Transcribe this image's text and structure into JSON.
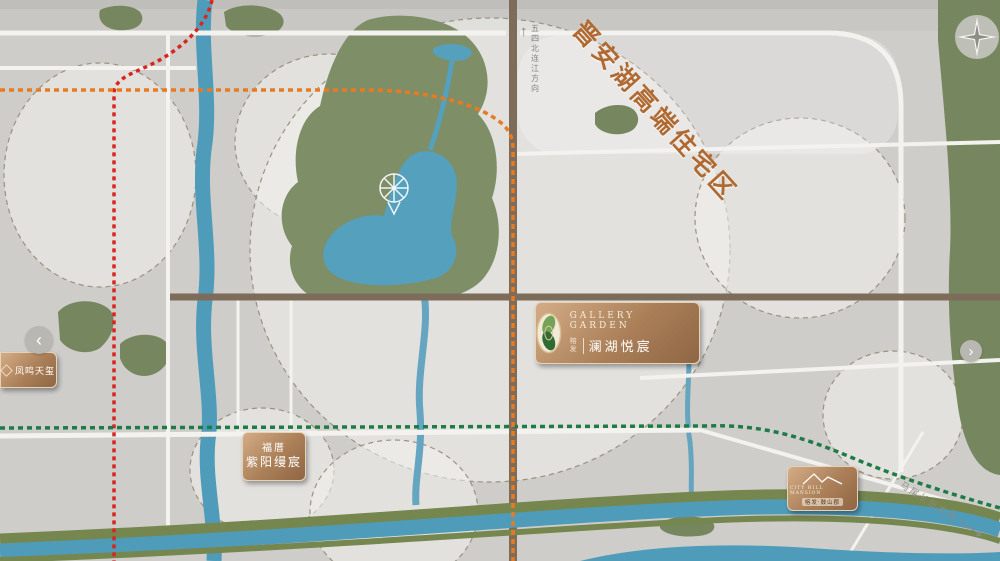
{
  "banner": "晋安湖高端住宅区",
  "project": {
    "en": "GALLERY GARDEN",
    "brand": "榕发",
    "name": "澜湖悦宸"
  },
  "boxes": {
    "phoenix": {
      "name": "凤鸣天玺"
    },
    "fucuo": {
      "line1": "福厝",
      "line2": "紫阳缦宸"
    },
    "cityhill": {
      "en": "CITY HILL MANSION",
      "zh": "榕发·鼓山郡"
    }
  },
  "carousel": {
    "left": "‹",
    "right": "›"
  },
  "compass": {
    "n": "N",
    "w": "W",
    "s": "S",
    "e": "E"
  },
  "directions": {
    "north": "五四北连江方向",
    "southeast": "马尾长乐方向"
  },
  "metro": {
    "lines": [
      {
        "id": "l1",
        "name": "地铁1号线",
        "color": "#d9251d"
      },
      {
        "id": "l2",
        "name": "地铁2号线",
        "color": "#1e7b45"
      },
      {
        "id": "l4",
        "name": "地铁4号线",
        "color": "#e87a22"
      }
    ],
    "stations": [
      {
        "name": "东街口站",
        "ix": 115,
        "iy": 91,
        "c": [
          "l1",
          "l4"
        ],
        "lx": 58,
        "ly": 86,
        "lw": 45,
        "lh": 14
      },
      {
        "name": "省立医院站",
        "ix": 144,
        "iy": 91,
        "c": [
          "l4"
        ],
        "lx": 117,
        "ly": 102,
        "lw": 56,
        "lh": 15
      },
      {
        "name": "东门站",
        "ix": 192,
        "iy": 91,
        "c": [
          "l4"
        ],
        "lx": 173,
        "ly": 102,
        "lw": 37,
        "lh": 15
      },
      {
        "name": "竹屿站",
        "ix": 390,
        "iy": 91,
        "c": [
          "l4"
        ],
        "lx": 370,
        "ly": 102,
        "lw": 39,
        "lh": 15
      },
      {
        "name": "横屿站",
        "ix": 512,
        "iy": 144,
        "c": [
          "l4"
        ],
        "lx": 521,
        "ly": 137,
        "lw": 39,
        "lh": 15
      },
      {
        "name": "后屿站",
        "big": 1,
        "ix": 517,
        "iy": 320,
        "c": [
          "l4"
        ],
        "lx": 447,
        "ly": 306,
        "lw": 59,
        "lh": 28
      },
      {
        "name": "前屿站",
        "ix": 513,
        "iy": 427,
        "c": [
          "l2",
          "l4"
        ],
        "lx": 464,
        "ly": 419,
        "lw": 38,
        "lh": 15
      },
      {
        "name": "光明港站",
        "ix": 512,
        "iy": 494,
        "c": [
          "l4"
        ],
        "lx": 454,
        "ly": 486,
        "lw": 48,
        "lh": 15
      },
      {
        "name": "鳌峰站",
        "ix": 512,
        "iy": 521,
        "c": [
          "l4"
        ],
        "lx": 467,
        "ly": 513,
        "lw": 37,
        "lh": 16
      },
      {
        "name": "五里亭站",
        "ix": 387,
        "iy": 426,
        "c": [
          "l2"
        ],
        "lx": 334,
        "ly": 418,
        "lw": 46,
        "lh": 15
      },
      {
        "name": "南门兜站",
        "ix": 114,
        "iy": 427,
        "c": [
          "l1",
          "l2"
        ],
        "lx": 56,
        "ly": 420,
        "lw": 47,
        "lh": 15
      }
    ]
  },
  "pills": [
    {
      "t": "前横路",
      "x": 504,
      "y": 29,
      "w": 19,
      "h": 69,
      "v": 1
    },
    {
      "t": "化工路",
      "x": 585,
      "y": 147,
      "w": 72,
      "h": 19
    },
    {
      "t": "福新东路",
      "x": 711,
      "y": 284,
      "w": 98,
      "h": 23
    },
    {
      "t": "后屿路",
      "x": 694,
      "y": 363,
      "w": 72,
      "h": 18
    },
    {
      "t": "古田路",
      "x": 134,
      "y": 422,
      "w": 71,
      "h": 25
    },
    {
      "t": "光明港路",
      "x": 374,
      "y": 504,
      "w": 78,
      "h": 18
    },
    {
      "t": "五一中路",
      "x": 159,
      "y": 276,
      "w": 18,
      "h": 58,
      "v": 1
    },
    {
      "t": "长乐路",
      "x": 229,
      "y": 331,
      "w": 17,
      "h": 81,
      "v": 1
    },
    {
      "t": "连江路",
      "x": 283,
      "y": 336,
      "w": 17,
      "h": 75,
      "v": 1
    },
    {
      "t": "东三环",
      "x": 899,
      "y": 268,
      "w": 19,
      "h": 56,
      "v": 1
    },
    {
      "t": "地铁4号线",
      "x": 243,
      "y": 84,
      "w": 90,
      "h": 17,
      "k": "l4"
    },
    {
      "t": "地铁2号线",
      "x": 712,
      "y": 416,
      "w": 76,
      "h": 16,
      "k": "l2"
    },
    {
      "t": "地铁1号线",
      "x": 105,
      "y": 456,
      "w": 17,
      "h": 66,
      "v": 1,
      "k": "l1"
    }
  ],
  "zone_labels": [
    {
      "text": "东街口商圈",
      "x": 84,
      "y": 148,
      "c": "green",
      "size": 11
    },
    {
      "text": "东泰禾商圈",
      "x": 340,
      "y": 164,
      "c": "green",
      "size": 11
    },
    {
      "lines": [
        "三创园",
        "经济核心区"
      ],
      "x": 752,
      "y": 197,
      "c": "orange",
      "size": 12
    },
    {
      "text": "宜家商圈",
      "x": 884,
      "y": 391,
      "c": "orange",
      "size": 11
    },
    {
      "text": "王庄商圈",
      "x": 266,
      "y": 484,
      "c": "gold",
      "size": 11
    },
    {
      "text": "金融街商圈",
      "x": 363,
      "y": 545,
      "c": "gold",
      "size": 11
    },
    {
      "text": "晋安湖公园",
      "x": 342,
      "y": 243,
      "c": "white",
      "size": 16,
      "ls": 6
    },
    {
      "text": "鼓山风景区",
      "x": 980,
      "y": 188,
      "c": "dgreen",
      "size": 10,
      "ls": 5,
      "v": 1
    }
  ],
  "river_labels": [
    {
      "text": "晋安河",
      "x": 202,
      "y": 342,
      "v": 1,
      "size": 8
    },
    {
      "text": "浦东河",
      "x": 684,
      "y": 370,
      "v": 1,
      "size": 6
    },
    {
      "text": "光明港",
      "x": 693,
      "y": 500,
      "size": 9,
      "ls": 4
    },
    {
      "text": "闽 江",
      "x": 648,
      "y": 548,
      "size": 10,
      "ls": 3
    }
  ],
  "pois": [
    {
      "t": [
        "东百中心"
      ],
      "x": 96,
      "y": 66,
      "i": "b"
    },
    {
      "t": [
        "三坊七巷",
        "历史文化街区"
      ],
      "x": 84,
      "y": 107,
      "i": "b"
    },
    {
      "t": [
        "大洋百货"
      ],
      "x": 135,
      "y": 123,
      "i": "b"
    },
    {
      "t": [
        "省立医院"
      ],
      "x": 141,
      "y": 72
    },
    {
      "t": [
        "福建省第二",
        "人民医院(东二环院区)"
      ],
      "x": 253,
      "y": 54,
      "i": "b"
    },
    {
      "t": [
        "福州第",
        "四十三",
        "中学"
      ],
      "x": 222,
      "y": 138,
      "i": "b"
    },
    {
      "t": [
        "泰禾广场"
      ],
      "x": 316,
      "y": 105,
      "i": "b"
    },
    {
      "t": [
        "福州新南方",
        "家居建材旗舰中心"
      ],
      "x": 322,
      "y": 181
    },
    {
      "t": [
        "福州市晋安",
        "榕博小学"
      ],
      "x": 357,
      "y": 57,
      "i": "b"
    },
    {
      "t": [
        "福州科技馆"
      ],
      "x": 486,
      "y": 69,
      "i": "b"
    },
    {
      "t": [
        "福州市",
        "晋安榕博小学",
        "(东区)"
      ],
      "x": 482,
      "y": 115
    },
    {
      "t": [
        "第十一中学"
      ],
      "x": 554,
      "y": 95,
      "i": "b"
    },
    {
      "t": [
        "福州市晋安区",
        "第二实验幼儿园"
      ],
      "x": 576,
      "y": 58,
      "i": "b"
    },
    {
      "t": [
        "横屿幼儿园"
      ],
      "x": 572,
      "y": 130,
      "i": "b",
      "p": "l"
    },
    {
      "t": [
        "福州市潭园小学"
      ],
      "x": 721,
      "y": 58
    },
    {
      "t": [
        "福州第十一中学",
        "(横屿校区)"
      ],
      "x": 724,
      "y": 99,
      "i": "b"
    },
    {
      "t": [
        "福建省儿童医院"
      ],
      "x": 779,
      "y": 102
    },
    {
      "t": [
        "福州市鼓山中心幼儿园"
      ],
      "x": 788,
      "y": 123,
      "i": "b"
    },
    {
      "t": [
        "三创中心"
      ],
      "x": 830,
      "y": 176,
      "i": "b"
    },
    {
      "t": [
        "未来科技大厦"
      ],
      "x": 810,
      "y": 235
    },
    {
      "t": [
        "IGG总部大厦"
      ],
      "x": 750,
      "y": 271
    },
    {
      "t": [
        "麦克赛尔",
        "数字映像(中国)"
      ],
      "x": 826,
      "y": 258,
      "i": "b"
    },
    {
      "t": [
        "梁厝",
        "科创园"
      ],
      "x": 700,
      "y": 243,
      "i": "b"
    },
    {
      "t": [
        "盛辉物流",
        "集团有限公司"
      ],
      "x": 560,
      "y": 188,
      "i": "b"
    },
    {
      "t": [
        "晋安区",
        "数字虚拟产业园"
      ],
      "x": 643,
      "y": 180,
      "i": "b"
    },
    {
      "t": [
        "福兴家居",
        "物联网展示中心"
      ],
      "x": 601,
      "y": 255,
      "i": "b"
    },
    {
      "t": [
        "福兴投资区"
      ],
      "x": 830,
      "y": 325,
      "i": "b",
      "p": "l"
    },
    {
      "t": [
        "高意科技"
      ],
      "x": 661,
      "y": 341
    },
    {
      "t": [
        "福兴妇产医院"
      ],
      "x": 754,
      "y": 396,
      "i": "h",
      "p": "l"
    },
    {
      "t": [
        "宜家"
      ],
      "x": 877,
      "y": 408,
      "i": "b"
    },
    {
      "t": [
        "福州格致中学",
        "(鼓山校区)"
      ],
      "x": 816,
      "y": 438,
      "i": "b"
    },
    {
      "t": [
        "晋安区",
        "气象局"
      ],
      "x": 497,
      "y": 355,
      "i": "s"
    },
    {
      "t": [
        "福州市",
        "鼓山中心小学"
      ],
      "x": 447,
      "y": 335,
      "i": "b"
    },
    {
      "t": [
        "鼓山中医院"
      ],
      "x": 452,
      "y": 379,
      "i": "b"
    },
    {
      "t": [
        "福州二十中"
      ],
      "x": 495,
      "y": 390,
      "i": "b"
    },
    {
      "t": [
        "福马商业广场"
      ],
      "x": 455,
      "y": 400,
      "i": "b"
    },
    {
      "t": [
        "福州博爱中医院"
      ],
      "x": 363,
      "y": 385,
      "i": "b"
    },
    {
      "t": [
        "晋安区教师进修",
        "学校附属小学"
      ],
      "x": 362,
      "y": 314,
      "i": "b"
    },
    {
      "t": [
        "福兴实验幼儿园"
      ],
      "x": 354,
      "y": 350,
      "i": "b",
      "p": "l"
    },
    {
      "t": [
        "大润发"
      ],
      "x": 262,
      "y": 373,
      "i": "b"
    },
    {
      "t": [
        "世欧",
        "广场"
      ],
      "x": 230,
      "y": 450,
      "i": "b"
    },
    {
      "t": [
        "沃尔玛(晋安店)"
      ],
      "x": 572,
      "y": 457,
      "i": "b",
      "p": "l"
    },
    {
      "t": [
        "福州市鼓山新区小学"
      ],
      "x": 570,
      "y": 477,
      "i": "b"
    },
    {
      "t": [
        "源脉温泉·温泉水乐园"
      ],
      "x": 730,
      "y": 481
    },
    {
      "t": [
        "远洋小学"
      ],
      "x": 766,
      "y": 465,
      "i": "b"
    },
    {
      "t": [
        "福州华伦中学",
        "(台江校区)"
      ],
      "x": 707,
      "y": 521,
      "i": "b"
    },
    {
      "t": [
        "富闽",
        "时代广场"
      ],
      "x": 428,
      "y": 516,
      "i": "b"
    },
    {
      "t": [
        "金融街万达广场"
      ],
      "x": 422,
      "y": 540,
      "i": "b"
    },
    {
      "t": [
        "鳌峰广场"
      ],
      "x": 340,
      "y": 512,
      "i": "b"
    },
    {
      "t": [
        "福建省宪法宣传教育馆"
      ],
      "x": 592,
      "y": 384,
      "i": "s",
      "p": "l"
    },
    {
      "t": [
        "福建省司法警察训练总队"
      ],
      "x": 575,
      "y": 403,
      "i": "s",
      "p": "l"
    },
    {
      "t": [
        "福州市",
        "人民政府"
      ],
      "x": 87,
      "y": 379,
      "i": "s"
    },
    {
      "t": [
        "建总商务大厦"
      ],
      "x": 528,
      "y": 304,
      "v": 1,
      "card": 1
    },
    {
      "t": [
        "五洲",
        "国际",
        "中心"
      ],
      "x": 498,
      "y": 243,
      "card": 1
    },
    {
      "t": [
        "温泉公园"
      ],
      "x": 119,
      "y": 17,
      "i": "t",
      "c": "w"
    },
    {
      "t": [
        "金鸡山公园"
      ],
      "x": 252,
      "y": 18,
      "i": "t",
      "c": "w",
      "p": "l"
    },
    {
      "t": [
        "牛岗山公园"
      ],
      "x": 424,
      "y": 35,
      "i": "t",
      "c": "w"
    },
    {
      "t": [
        "雨花溪湖"
      ],
      "x": 457,
      "y": 50,
      "c": "w"
    },
    {
      "t": [
        "晋安",
        "体育馆"
      ],
      "x": 432,
      "y": 60,
      "i": "b",
      "c": "w"
    },
    {
      "t": [
        "鹤林",
        "生态公园"
      ],
      "x": 448,
      "y": 112,
      "i": "t",
      "c": "w"
    },
    {
      "t": [
        "晋安公园"
      ],
      "x": 444,
      "y": 140,
      "i": "t",
      "c": "w",
      "p": "l"
    },
    {
      "t": [
        "福州之光·晋安湖摩天轮"
      ],
      "x": 395,
      "y": 205,
      "c": "w"
    },
    {
      "t": [
        "福州市",
        "文化馆"
      ],
      "x": 465,
      "y": 180,
      "c": "w"
    },
    {
      "t": [
        "福州市少年",
        "儿童图书馆"
      ],
      "x": 464,
      "y": 207,
      "c": "w"
    },
    {
      "t": [
        "一鉴湖城",
        "茶馆"
      ],
      "x": 452,
      "y": 246,
      "c": "w"
    },
    {
      "t": [
        "杉澄秋月"
      ],
      "x": 447,
      "y": 272,
      "c": "w",
      "i": "t",
      "p": "l"
    },
    {
      "t": [
        "乌山历史",
        "风貌区"
      ],
      "x": 83,
      "y": 320,
      "i": "t",
      "c": "w"
    },
    {
      "t": [
        "于山风景",
        "名胜公园"
      ],
      "x": 143,
      "y": 347,
      "i": "t",
      "c": "w"
    },
    {
      "t": [
        "横屿山公园"
      ],
      "x": 616,
      "y": 117,
      "i": "t",
      "c": "w",
      "p": "l"
    },
    {
      "t": [
        "光明港公园"
      ],
      "x": 549,
      "y": 493,
      "c": "w",
      "i": "t",
      "p": "l"
    },
    {
      "t": [
        "鳌峰公园"
      ],
      "x": 692,
      "y": 520,
      "c": "w",
      "i": "t",
      "p": "l"
    }
  ],
  "buildings": [
    {
      "x": 129,
      "y": 47,
      "w": 26,
      "h": 30
    },
    {
      "x": 318,
      "y": 113,
      "w": 78,
      "h": 40,
      "lt": 1
    },
    {
      "x": 333,
      "y": 468,
      "w": 58,
      "h": 54
    },
    {
      "x": 697,
      "y": 28,
      "w": 46,
      "h": 30
    },
    {
      "x": 762,
      "y": 56,
      "w": 26,
      "h": 45
    },
    {
      "x": 792,
      "y": 186,
      "w": 17,
      "h": 49
    },
    {
      "x": 731,
      "y": 224,
      "w": 28,
      "h": 47
    },
    {
      "x": 646,
      "y": 304,
      "w": 26,
      "h": 37
    },
    {
      "x": 701,
      "y": 463,
      "w": 48,
      "h": 16
    },
    {
      "x": 287,
      "y": 466,
      "w": 15,
      "h": 21
    },
    {
      "x": 452,
      "y": 171,
      "w": 26,
      "h": 7,
      "lt": 1
    },
    {
      "x": 450,
      "y": 198,
      "w": 28,
      "h": 7,
      "lt": 1
    },
    {
      "x": 487,
      "y": 229,
      "w": 22,
      "h": 11,
      "lt": 1
    }
  ]
}
